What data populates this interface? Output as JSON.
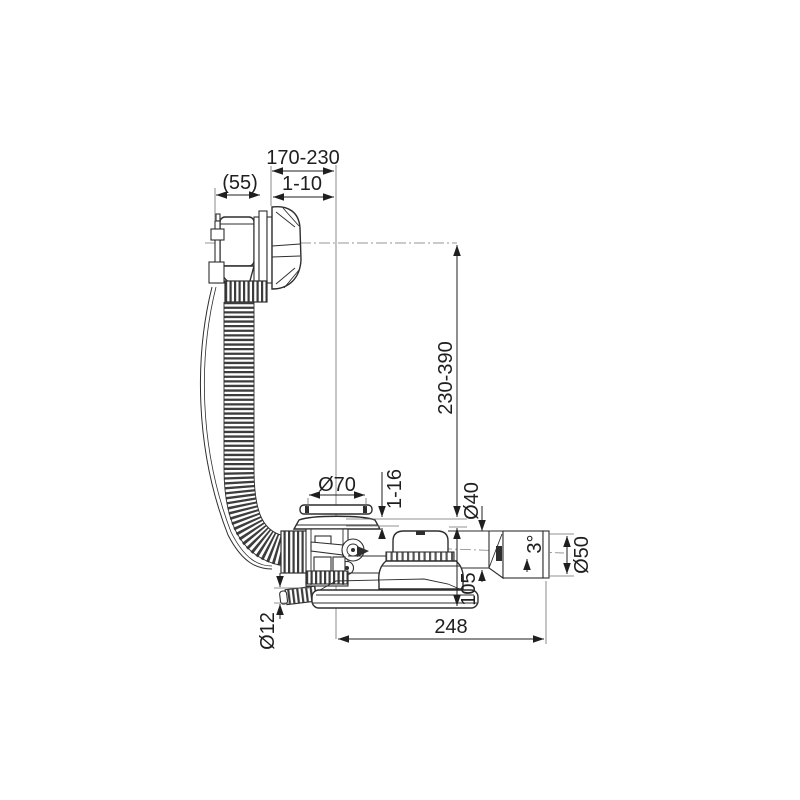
{
  "drawing": {
    "colors": {
      "line": "#2e2e2e",
      "background": "#ffffff",
      "text": "#1f1f1f"
    },
    "dimensions": {
      "span_top": "170-230",
      "head_width": "(55)",
      "knob_travel": "1-10",
      "hose_length": "230-390",
      "plug_diameter": "Ø70",
      "rim_adjust": "1-16",
      "pipe_diameter": "Ø40",
      "outlet_slope": "3°",
      "outlet_diameter": "Ø50",
      "trap_height": "105",
      "overall_length": "248",
      "nozzle_diameter": "Ø12"
    }
  }
}
